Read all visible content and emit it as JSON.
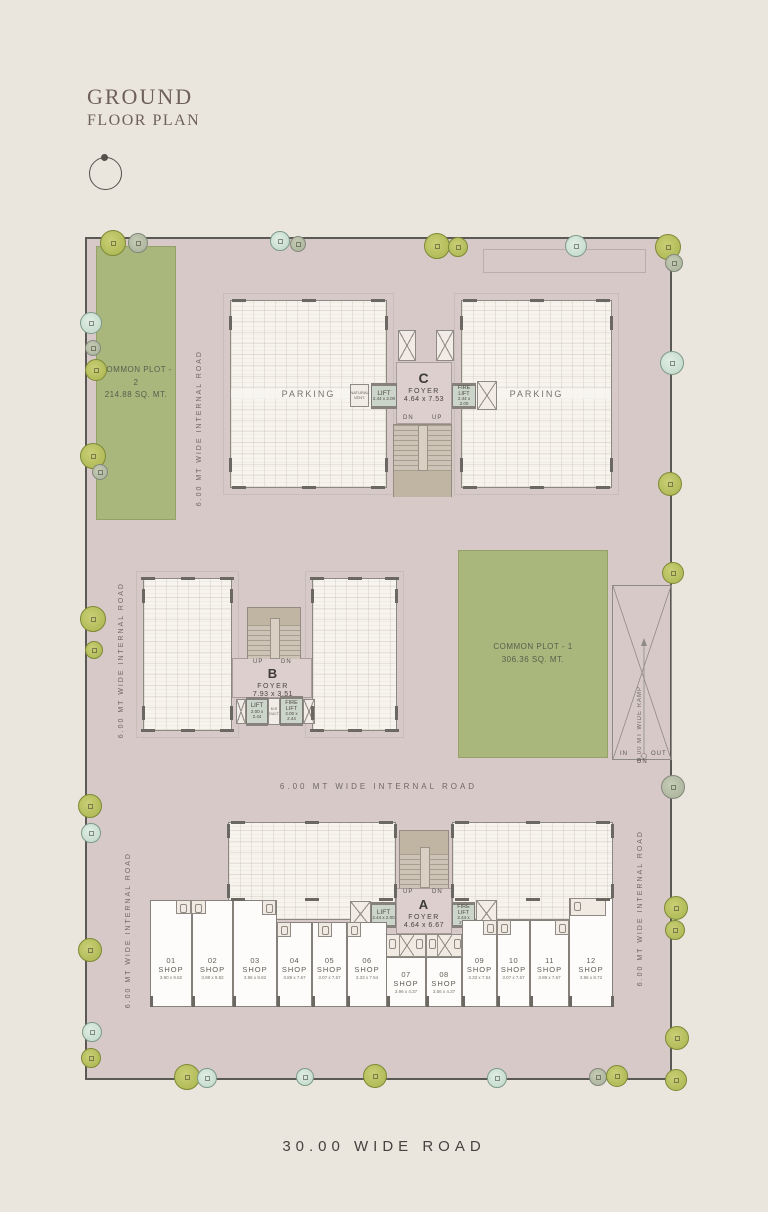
{
  "title": {
    "line1": "GROUND",
    "line2": "FLOOR PLAN"
  },
  "roads": {
    "internal": "6.00 MT WIDE INTERNAL ROAD",
    "bottom": "30.00 WIDE ROAD",
    "ramp": "6.00 MT WIDE RAMP",
    "ramp_in": "IN",
    "ramp_out": "OUT",
    "ramp_dn": "DN"
  },
  "plots": {
    "plot1": {
      "name": "COMMON PLOT - 1",
      "area": "306.36 SQ. MT."
    },
    "plot2": {
      "name": "COMMON PLOT - 2",
      "area": "214.88 SQ. MT."
    }
  },
  "towers": {
    "a": {
      "label": "A",
      "foyer": "FOYER",
      "size": "4.64 x 6.67",
      "lift": "LIFT",
      "lift_size": "2.44 x 2.00",
      "fire_lift": "FIRE LIFT",
      "fire_lift_size": "2.44 x 2.00",
      "up": "UP",
      "dn": "DN"
    },
    "b": {
      "label": "B",
      "foyer": "FOYER",
      "size": "7.93 x 3.51",
      "lift": "LIFT",
      "lift_size": "2.00 x 2.44",
      "fire_lift": "FIRE LIFT",
      "fire_lift_size": "2.00 x 2.44",
      "mr_duct": "M.R DUCT",
      "up": "UP",
      "dn": "DN"
    },
    "c": {
      "label": "C",
      "foyer": "FOYER",
      "size": "4.64 x 7.53",
      "lift": "LIFT",
      "lift_size": "2.44 x 2.00",
      "fire_lift": "FIRE LIFT",
      "fire_lift_size": "2.44 x 2.00",
      "vent": "NATURAL VENT.",
      "up": "UP",
      "dn": "DN",
      "parking_left": "PARKING",
      "parking_right": "PARKING"
    }
  },
  "shops": [
    {
      "no": "01",
      "type": "SHOP",
      "size": "3.90 x 9.82"
    },
    {
      "no": "02",
      "type": "SHOP",
      "size": "3.98 x 9.82"
    },
    {
      "no": "03",
      "type": "SHOP",
      "size": "3.96 x 9.82"
    },
    {
      "no": "04",
      "type": "SHOP",
      "size": "3.89 x 7.67"
    },
    {
      "no": "05",
      "type": "SHOP",
      "size": "3.07 x 7.67"
    },
    {
      "no": "06",
      "type": "SHOP",
      "size": "3.33 x 7.54"
    },
    {
      "no": "07",
      "type": "SHOP",
      "size": "3.96 x 4.37"
    },
    {
      "no": "08",
      "type": "SHOP",
      "size": "3.56 x 4.37"
    },
    {
      "no": "09",
      "type": "SHOP",
      "size": "3.33 x 7.54"
    },
    {
      "no": "10",
      "type": "SHOP",
      "size": "3.07 x 7.67"
    },
    {
      "no": "11",
      "type": "SHOP",
      "size": "3.89 x 7.67"
    },
    {
      "no": "12",
      "type": "SHOP",
      "size": "3.96 x 8.72"
    }
  ],
  "colors": {
    "page_bg": "#eae6de",
    "site_fill": "#d8c9c9",
    "building_fill": "#f7f4ee",
    "green_plot": "#a9b77c",
    "lift_fill": "#ccd5c9",
    "stair_fill": "#cdc3b6",
    "boundary": "#5b5955",
    "label_text": "#6f6761"
  },
  "trees": [
    {
      "x": 113,
      "y": 243,
      "r": 13,
      "v": "o"
    },
    {
      "x": 138,
      "y": 243,
      "r": 10,
      "v": "g"
    },
    {
      "x": 280,
      "y": 241,
      "r": 10,
      "v": "t"
    },
    {
      "x": 298,
      "y": 244,
      "r": 8,
      "v": "g"
    },
    {
      "x": 437,
      "y": 246,
      "r": 13,
      "v": "o"
    },
    {
      "x": 458,
      "y": 247,
      "r": 10,
      "v": "o"
    },
    {
      "x": 576,
      "y": 246,
      "r": 11,
      "v": "t"
    },
    {
      "x": 668,
      "y": 247,
      "r": 13,
      "v": "o"
    },
    {
      "x": 674,
      "y": 263,
      "r": 9,
      "v": "g"
    },
    {
      "x": 91,
      "y": 323,
      "r": 11,
      "v": "t"
    },
    {
      "x": 93,
      "y": 348,
      "r": 8,
      "v": "g"
    },
    {
      "x": 96,
      "y": 370,
      "r": 11,
      "v": "o"
    },
    {
      "x": 93,
      "y": 456,
      "r": 13,
      "v": "o"
    },
    {
      "x": 100,
      "y": 472,
      "r": 8,
      "v": "g"
    },
    {
      "x": 93,
      "y": 619,
      "r": 13,
      "v": "o"
    },
    {
      "x": 94,
      "y": 650,
      "r": 9,
      "v": "o"
    },
    {
      "x": 90,
      "y": 806,
      "r": 12,
      "v": "o"
    },
    {
      "x": 91,
      "y": 833,
      "r": 10,
      "v": "t"
    },
    {
      "x": 90,
      "y": 950,
      "r": 12,
      "v": "o"
    },
    {
      "x": 92,
      "y": 1032,
      "r": 10,
      "v": "t"
    },
    {
      "x": 91,
      "y": 1058,
      "r": 10,
      "v": "o"
    },
    {
      "x": 672,
      "y": 363,
      "r": 12,
      "v": "t"
    },
    {
      "x": 670,
      "y": 484,
      "r": 12,
      "v": "o"
    },
    {
      "x": 673,
      "y": 573,
      "r": 11,
      "v": "o"
    },
    {
      "x": 673,
      "y": 787,
      "r": 12,
      "v": "g"
    },
    {
      "x": 676,
      "y": 908,
      "r": 12,
      "v": "o"
    },
    {
      "x": 675,
      "y": 930,
      "r": 10,
      "v": "o"
    },
    {
      "x": 677,
      "y": 1038,
      "r": 12,
      "v": "o"
    },
    {
      "x": 187,
      "y": 1077,
      "r": 13,
      "v": "o"
    },
    {
      "x": 207,
      "y": 1078,
      "r": 10,
      "v": "t"
    },
    {
      "x": 305,
      "y": 1077,
      "r": 9,
      "v": "t"
    },
    {
      "x": 375,
      "y": 1076,
      "r": 12,
      "v": "o"
    },
    {
      "x": 497,
      "y": 1078,
      "r": 10,
      "v": "t"
    },
    {
      "x": 598,
      "y": 1077,
      "r": 9,
      "v": "g"
    },
    {
      "x": 617,
      "y": 1076,
      "r": 11,
      "v": "o"
    },
    {
      "x": 676,
      "y": 1080,
      "r": 11,
      "v": "o"
    }
  ]
}
